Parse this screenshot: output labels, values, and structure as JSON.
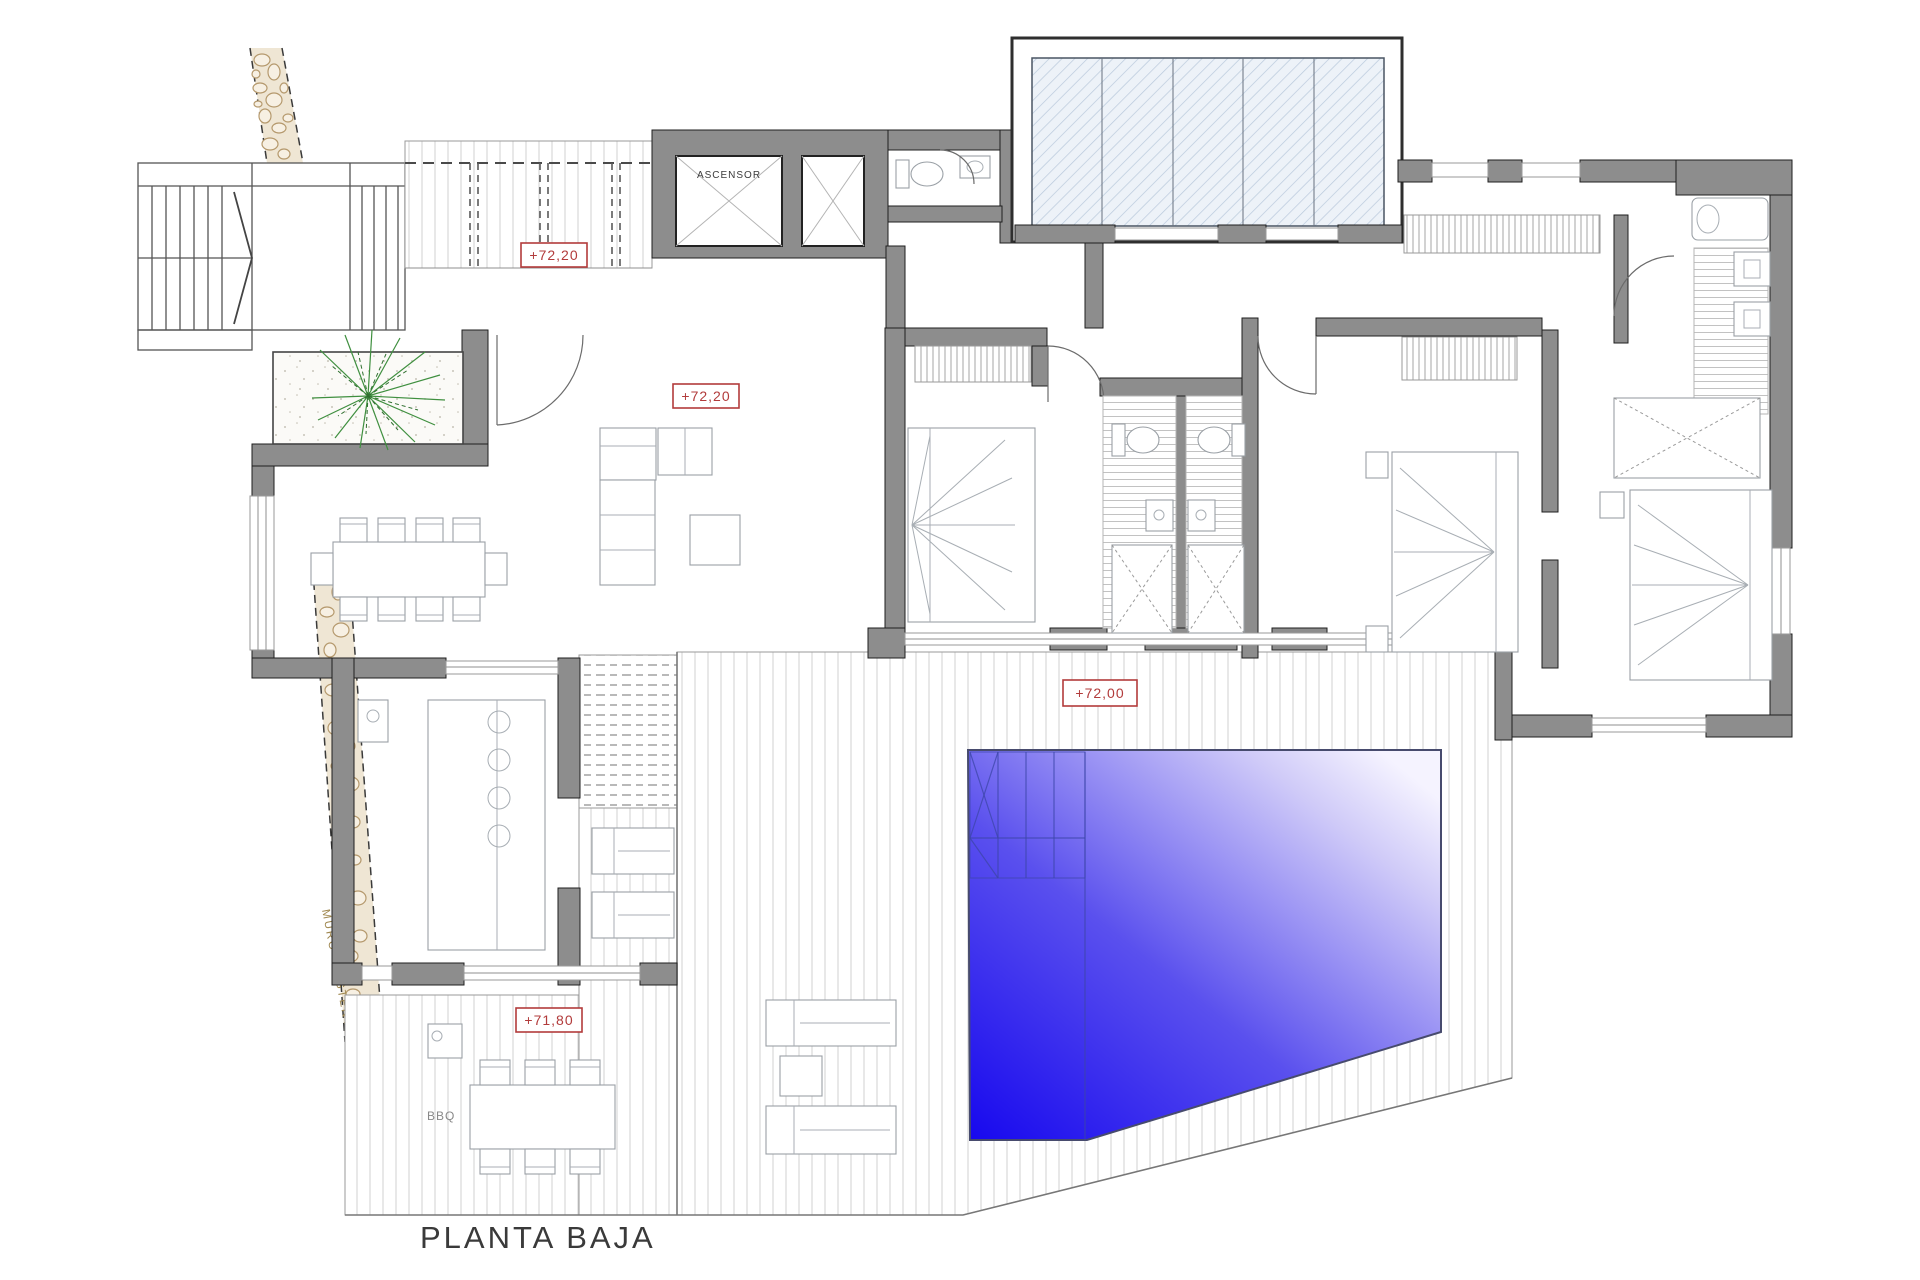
{
  "plan": {
    "title": "PLANTA BAJA",
    "annotations": {
      "elevator": "ASCENSOR",
      "existing_wall": "MURO EXISTENTE",
      "bbq": "BBQ"
    },
    "level_labels": {
      "entry_porch": "+72,20",
      "living_room": "+72,20",
      "pool_deck": "+72,00",
      "bbq_terrace": "+71,80"
    },
    "colors": {
      "wall_gray": "#8d8d8d",
      "label_red": "#b23b3b",
      "pool_blue_deep": "#1708ee",
      "pool_blue_light": "#f5f3ff",
      "stone_tan": "#efe6d4",
      "stone_edge": "#b5996d",
      "plant_green": "#3f8f3f",
      "skylight_glass": "#eef2f8",
      "skylight_hatch": "#b9c9dc",
      "text_dark": "#3a3a3a"
    }
  }
}
